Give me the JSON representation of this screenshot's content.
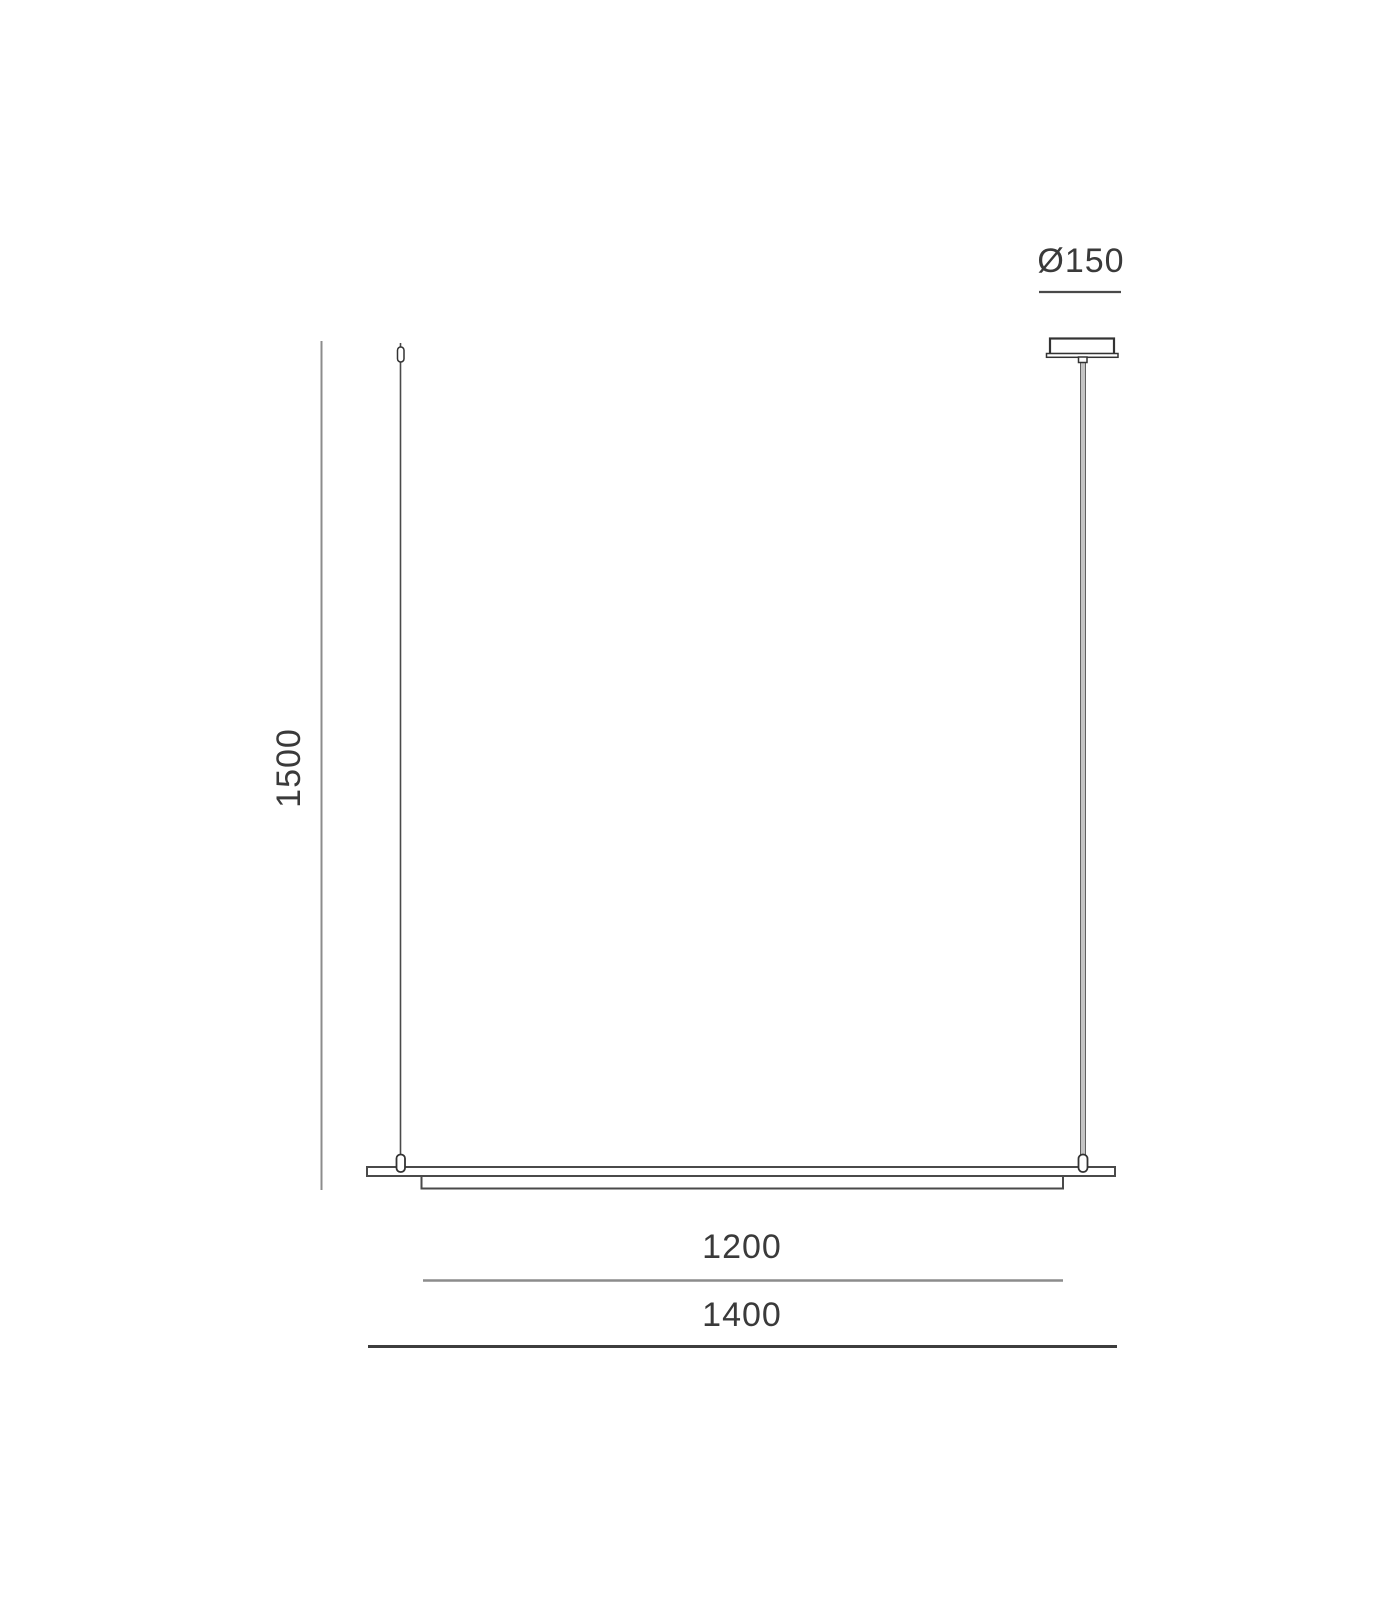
{
  "diagram": {
    "labels": {
      "height": "1500",
      "inner_width": "1200",
      "overall_width": "1400",
      "canopy_diameter": "Ø150"
    },
    "colors": {
      "background": "#ffffff",
      "outline_dark": "#3d3d3d",
      "dimension_gray": "#8c8c8c",
      "text": "#3a3a3a",
      "rod_fill": "#c4c4c4"
    }
  }
}
